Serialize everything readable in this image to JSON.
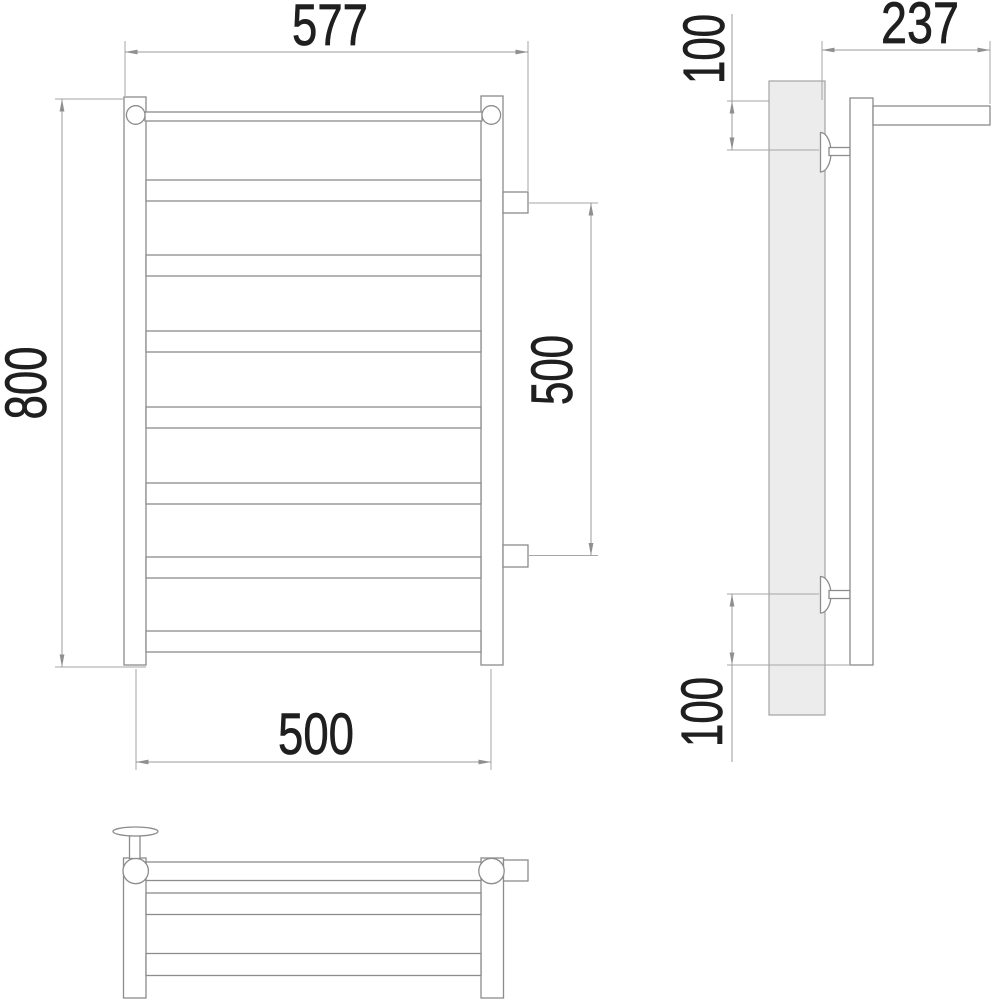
{
  "drawing": {
    "colors": {
      "background": "#ffffff",
      "geometry_line": "#8c8c8c",
      "dimension_line": "#9b9b9b",
      "dimension_text": "#1f1f1f",
      "wall_panel_fill": "#ececec"
    },
    "views": {
      "front_view": {
        "rung_count": 7,
        "connection_stub_count": 2
      },
      "side_view": {
        "wall_bracket_count": 2
      },
      "bottom_view": {
        "rung_strip_count": 2
      }
    },
    "dimensions": {
      "overall_width_mm": "577",
      "overall_height_mm": "800",
      "bottom_center_width_mm": "500",
      "side_connection_spacing_mm": "500",
      "depth_mm": "237",
      "top_bracket_offset_mm": "100",
      "bottom_bracket_offset_mm": "100"
    }
  }
}
